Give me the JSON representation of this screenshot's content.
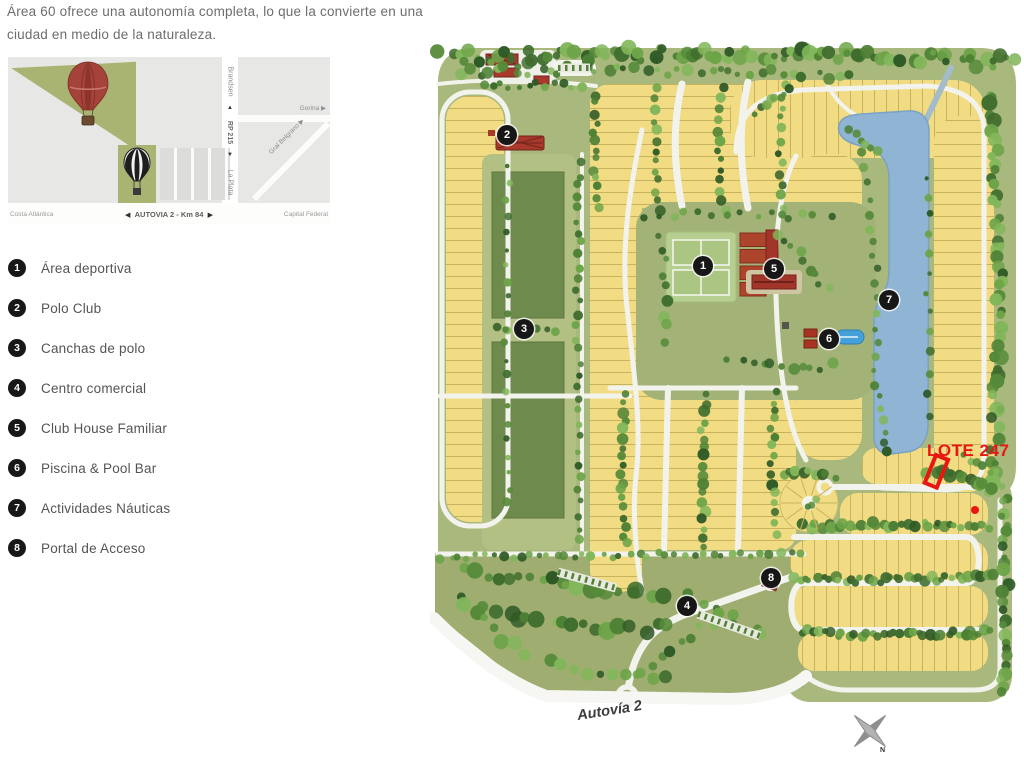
{
  "header": {
    "line1": "Área 60 ofrece una autonomía completa, lo que la convierte en una",
    "line2": "ciudad en medio de la naturaleza."
  },
  "inset": {
    "route_vertical": {
      "destination_top": "Brandsen",
      "route_name": "RP 215",
      "destination_bottom": "La Plata",
      "arrow_up": "▲",
      "arrow_down": "▼"
    },
    "side_roads": {
      "east_road": "Gorina ▶",
      "diagonal_road": "Gral Belgrano ▶"
    },
    "bottom_road": {
      "left": "Costa Atlántica",
      "arrow_left": "◀",
      "center": "AUTOVIA 2 - Km 84",
      "arrow_right": "▶",
      "right": "Capital Federal"
    }
  },
  "legend": {
    "items": [
      {
        "number": "1",
        "label": "Área deportiva"
      },
      {
        "number": "2",
        "label": "Polo Club"
      },
      {
        "number": "3",
        "label": "Canchas de polo"
      },
      {
        "number": "4",
        "label": "Centro comercial"
      },
      {
        "number": "5",
        "label": "Club House Familiar"
      },
      {
        "number": "6",
        "label": "Piscina & Pool Bar"
      },
      {
        "number": "7",
        "label": "Actividades Náuticas"
      },
      {
        "number": "8",
        "label": "Portal de Acceso"
      }
    ]
  },
  "map": {
    "markers": [
      {
        "number": "1",
        "x": 273,
        "y": 230
      },
      {
        "number": "2",
        "x": 77,
        "y": 99
      },
      {
        "number": "3",
        "x": 94,
        "y": 293
      },
      {
        "number": "4",
        "x": 257,
        "y": 570
      },
      {
        "number": "5",
        "x": 344,
        "y": 233
      },
      {
        "number": "6",
        "x": 399,
        "y": 303
      },
      {
        "number": "7",
        "x": 459,
        "y": 264
      },
      {
        "number": "8",
        "x": 341,
        "y": 542
      }
    ],
    "highlight": {
      "label": "LOTE 247"
    },
    "road_label": "Autovía 2",
    "compass": {
      "north": "N"
    }
  },
  "colors": {
    "lot_yellow": "#f1dc84",
    "base_green": "#a9b87d",
    "polo_green": "#6f8a4d",
    "lake_blue": "#8fb4d4",
    "highlight_red": "#e81712",
    "marker_black": "#171717"
  }
}
